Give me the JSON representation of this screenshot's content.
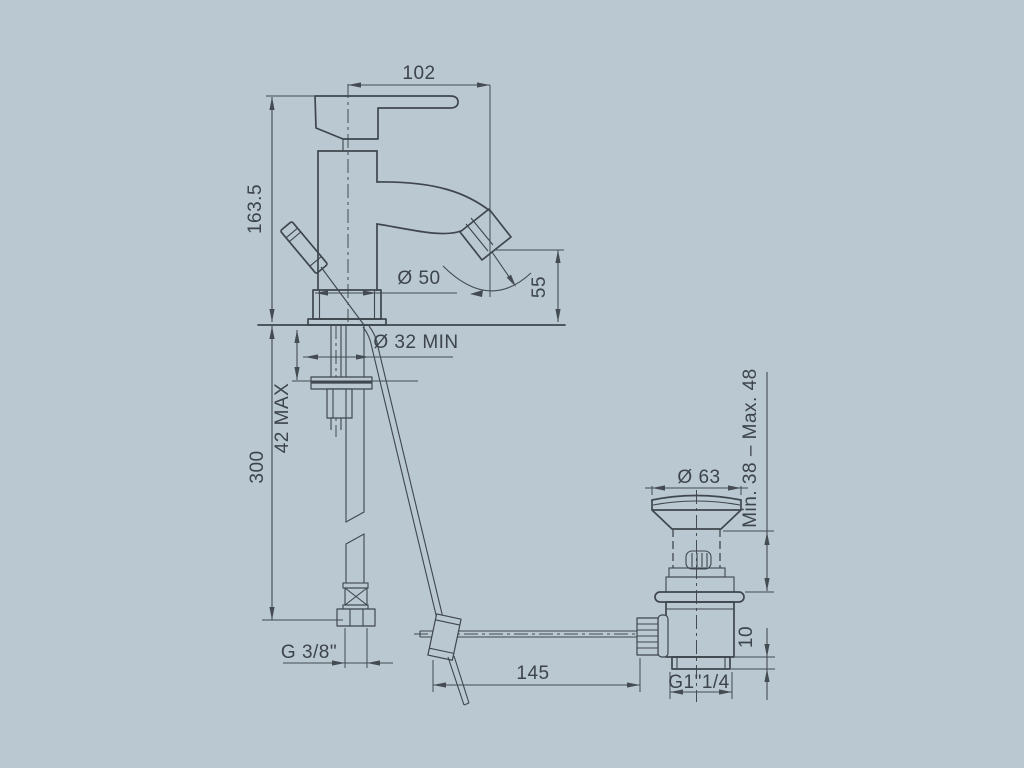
{
  "drawing": {
    "type": "basin-mixer-technical-drawing",
    "colors": {
      "background": "#b9c8d1",
      "line": "#3f464e",
      "dimension": "#444b53",
      "text": "#3d444c"
    },
    "dims": {
      "spout_reach": "102",
      "height": "163.5",
      "outlet_height": "55",
      "body_dia": "Ø 50",
      "hole_dia": "Ø 32 MIN",
      "deck_max": "42 MAX",
      "hose_length": "300",
      "hose_thread": "G 3/8\"",
      "rod_length": "145",
      "drain_dia": "Ø 63",
      "clamp_range": "Min. 38 – Max. 48",
      "tail_height": "10",
      "drain_thread": "G1\"1/4"
    }
  }
}
